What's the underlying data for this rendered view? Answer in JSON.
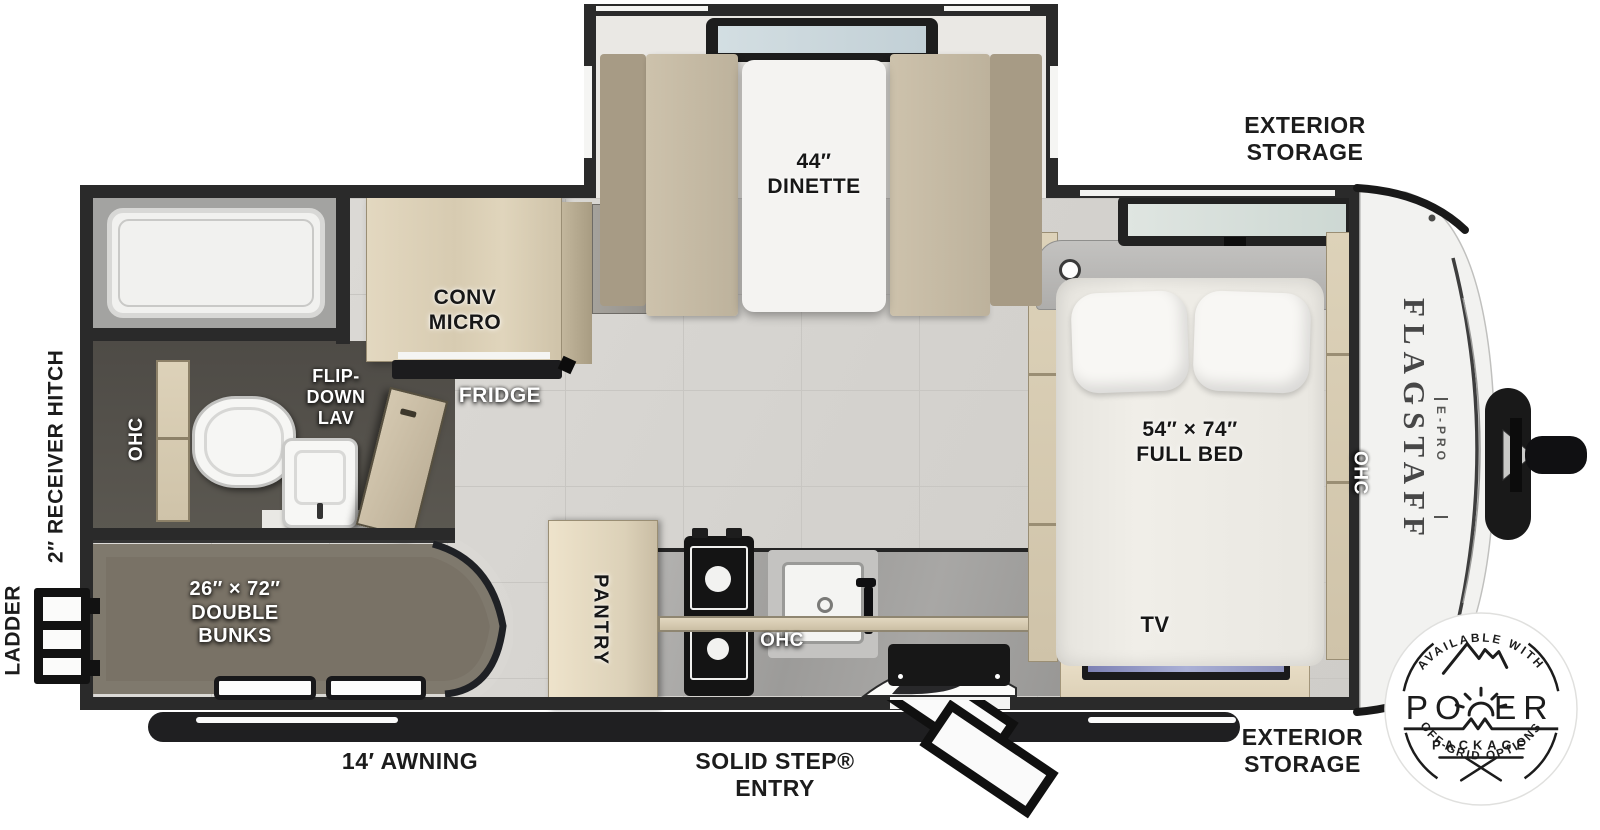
{
  "canvas": {
    "width": 1600,
    "height": 830
  },
  "colors": {
    "wall": "#2a2a2a",
    "floor": "#d9d7d3",
    "floor_line": "#c6c4c0",
    "wood": "#ddd2b9",
    "cushion": "#c7bca6",
    "cushion_back": "#a79b85",
    "bath_floor": "#57544e",
    "bunk": "#797266",
    "counter": "#a6a5a3",
    "dark_appliance": "#161616",
    "bed": "#edebe5",
    "cap": "#f2f2f0",
    "tv_screen": "#8d92bd",
    "badge_ink": "#1c1c1c"
  },
  "exterior_labels": {
    "storage_top": "EXTERIOR\nSTORAGE",
    "storage_bottom": "EXTERIOR\nSTORAGE",
    "awning": "14′ AWNING",
    "entry": "SOLID STEP®\nENTRY",
    "receiver_hitch": "2″ RECEIVER HITCH",
    "ladder": "LADDER"
  },
  "interior_labels": {
    "dinette": "44″\nDINETTE",
    "conv_micro": "CONV\nMICRO",
    "fridge": "FRIDGE",
    "flip_down_lav": "FLIP-\nDOWN\nLAV",
    "bath_ohc": "OHC",
    "bunks": "26″ × 72″\nDOUBLE\nBUNKS",
    "pantry": "PANTRY",
    "kitchen_ohc": "OHC",
    "bed": "54″ × 74″\nFULL BED",
    "bed_ohc": "OHC",
    "tv": "TV"
  },
  "brand": {
    "name": "FLAGSTAFF",
    "sub": "E-PRO"
  },
  "badge": {
    "top": "AVAILABLE WITH",
    "power_left": "PO",
    "power_right": "ER",
    "power_word": "POWER",
    "package": "PACKAGE",
    "bottom": "OFF-GRID OPTIONS"
  }
}
